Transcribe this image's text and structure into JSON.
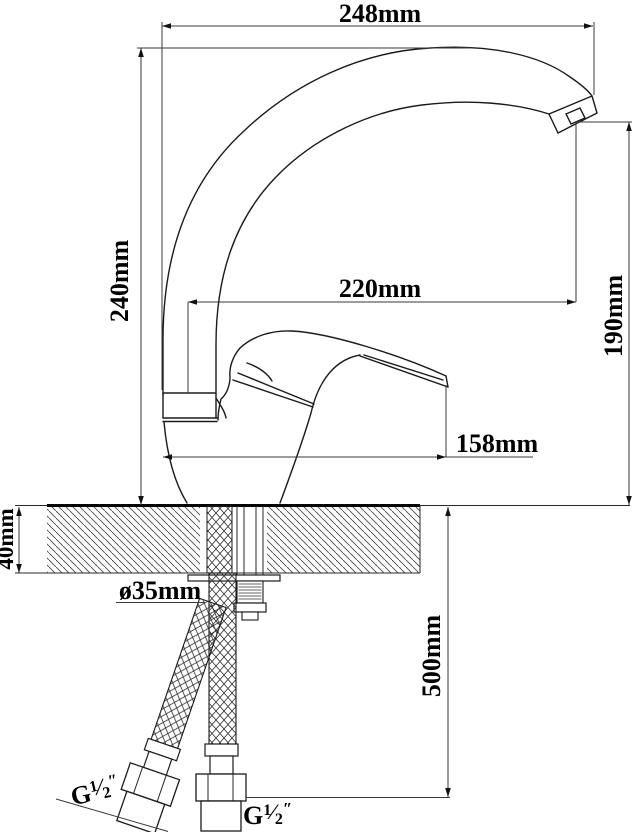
{
  "drawing": {
    "type": "technical dimension drawing",
    "subject": "single-lever kitchen faucet, side elevation with countertop mounting and flexible supply hoses",
    "units": "mm",
    "dimensions": {
      "overall_length": "248mm",
      "overall_height": "240mm",
      "spout_reach": "220mm",
      "spout_outlet_height": "190mm",
      "body_length": "158mm",
      "counter_thickness": "40mm",
      "mounting_hole_diameter": "ø35mm",
      "hose_length": "500mm"
    },
    "thread_label": {
      "g": "G",
      "numerator": "1",
      "fraction_slash": "⁄",
      "denominator": "2",
      "inch_mark": "″"
    }
  }
}
